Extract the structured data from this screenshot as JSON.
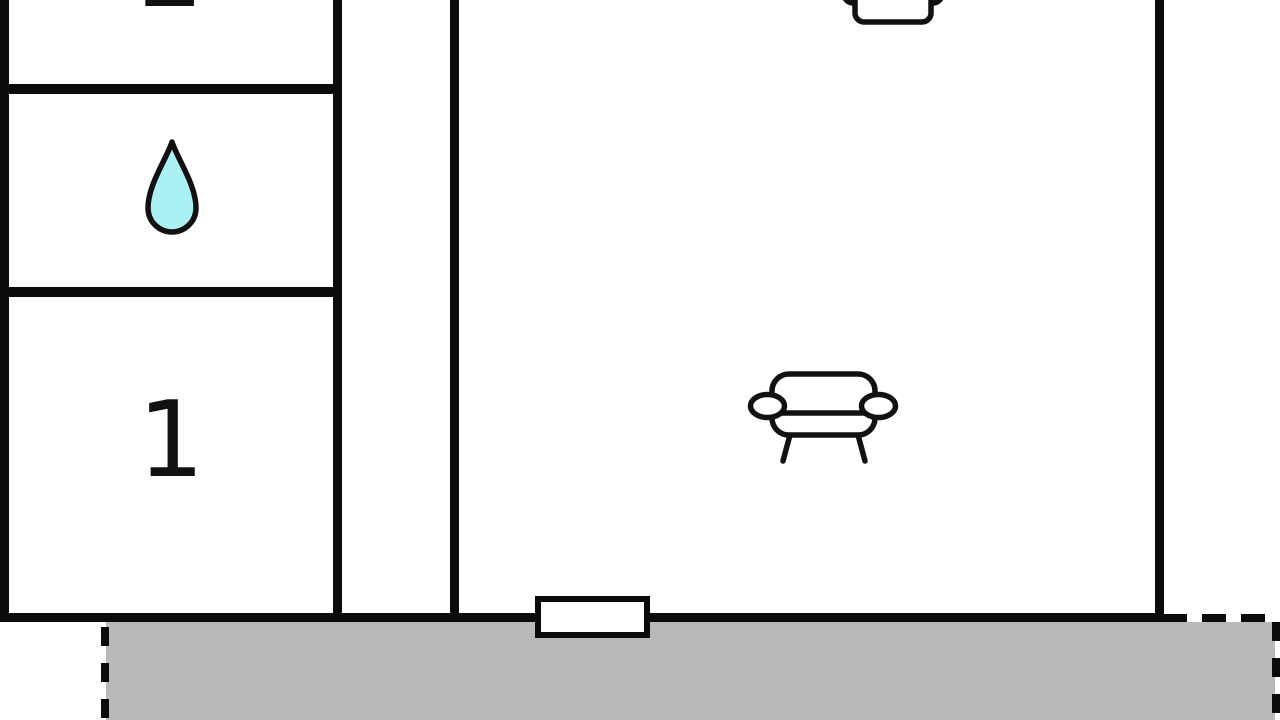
{
  "colors": {
    "background": "#ffffff",
    "wall": "#0b0b0b",
    "terrace": "#b9b9b9",
    "waterdrop": "#abf0f2",
    "line": "#111111"
  },
  "rooms": {
    "room2": {
      "label": "2"
    },
    "bathroom": {
      "icon": "water-drop-icon"
    },
    "room1": {
      "label": "1"
    },
    "hallway": {},
    "living_room": {
      "icons": [
        "armchair-icon",
        "sofa-icon"
      ]
    },
    "terrace": {}
  },
  "features": {
    "door_opening": "bottom-center door/window symbol",
    "terrace_boundary": "dashed outline"
  }
}
